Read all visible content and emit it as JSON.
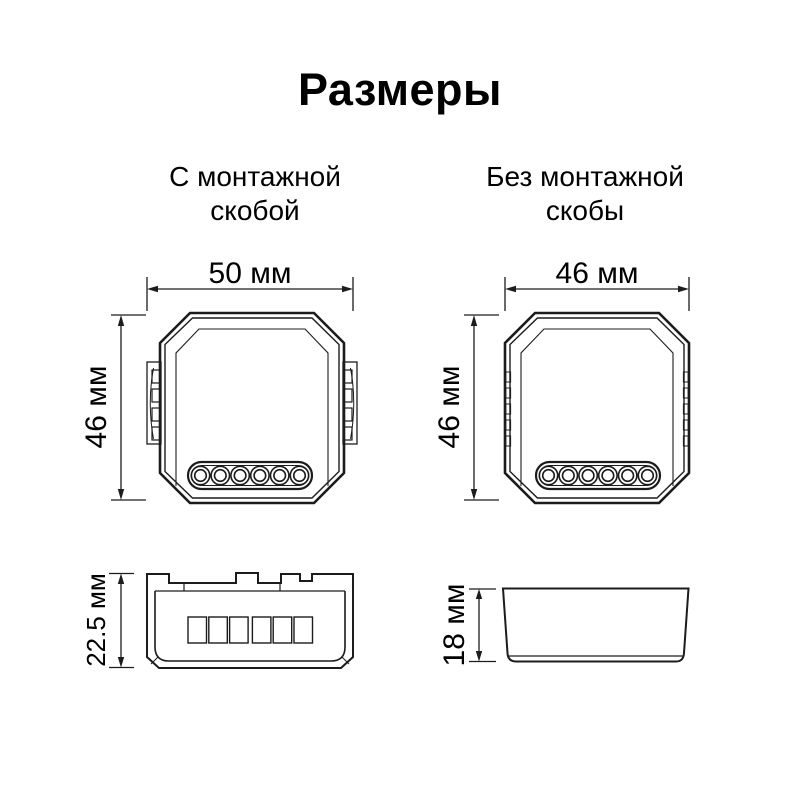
{
  "title": "Размеры",
  "with_bracket": {
    "heading": "С монтажной\nскобой",
    "front": {
      "width_label": "50 мм",
      "height_label": "46 мм"
    },
    "side": {
      "depth_label": "22.5 мм"
    }
  },
  "without_bracket": {
    "heading": "Без монтажной\nскобы",
    "front": {
      "width_label": "46 мм",
      "height_label": "46 мм"
    },
    "side": {
      "depth_label": "18 мм"
    }
  },
  "colors": {
    "line": "#1c1c1c",
    "text": "#000000",
    "background": "#ffffff"
  }
}
